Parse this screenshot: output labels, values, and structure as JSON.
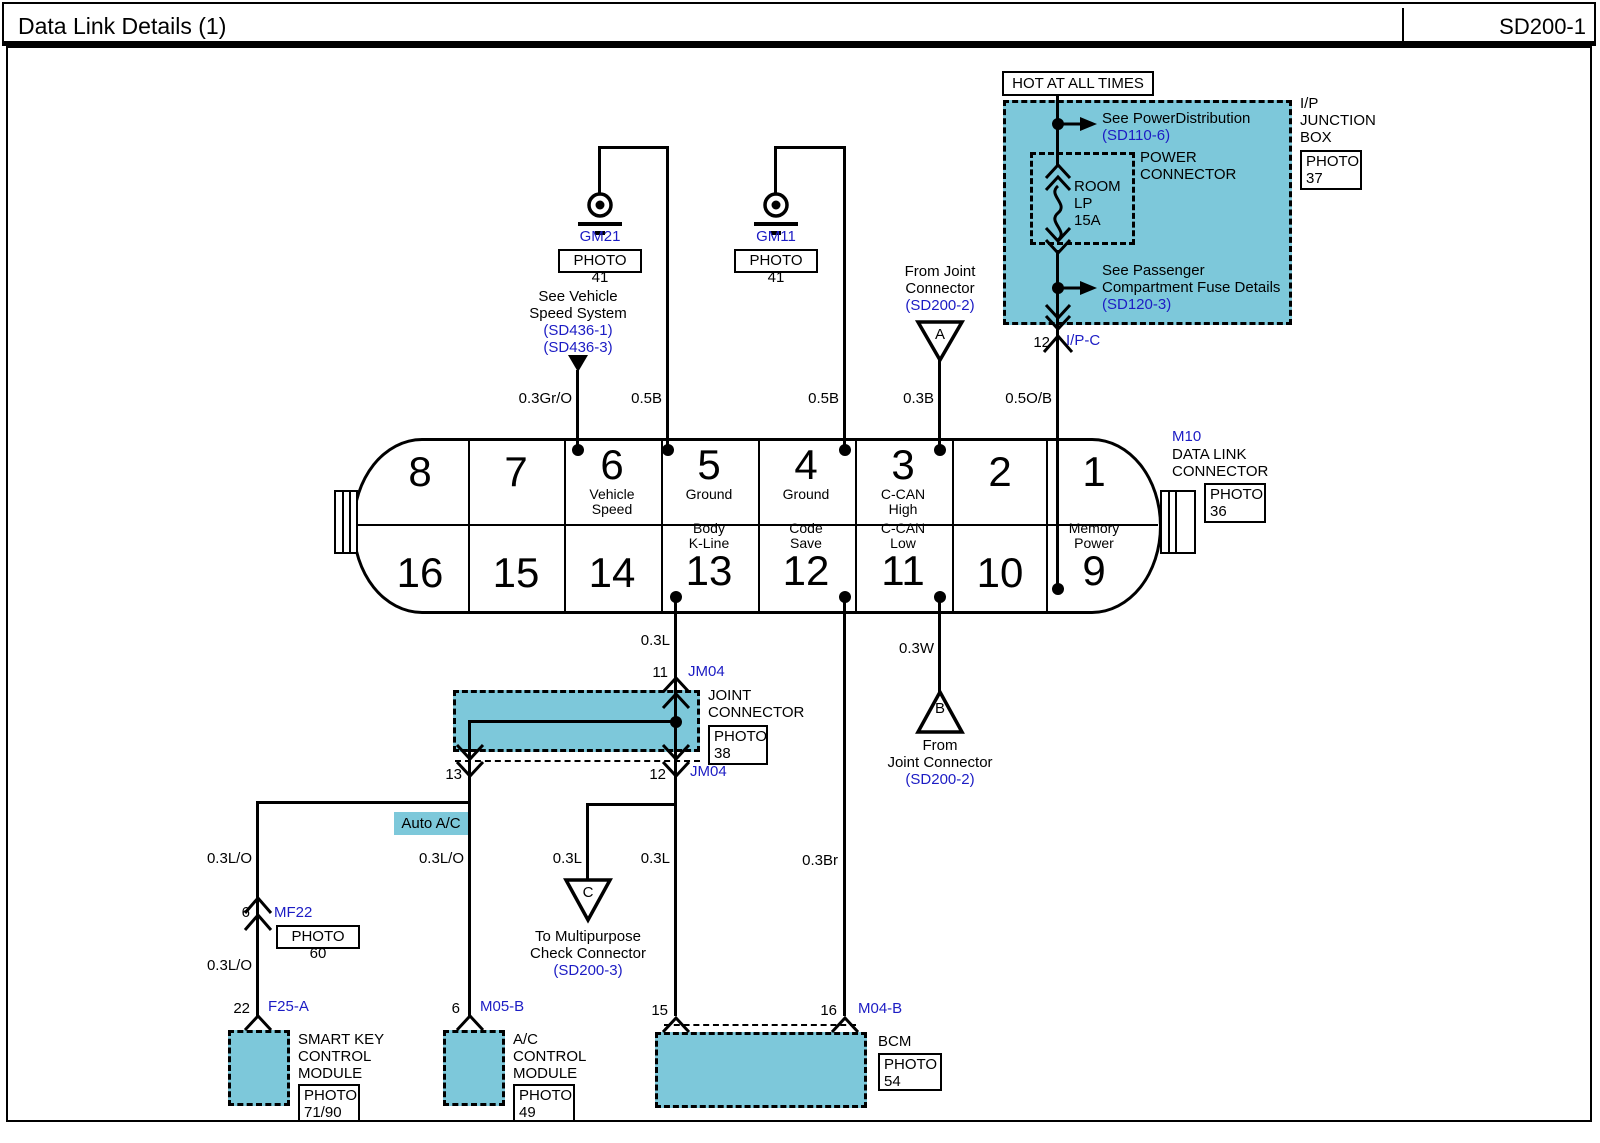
{
  "header": {
    "title": "Data Link Details (1)",
    "code": "SD200-1"
  },
  "colors": {
    "teal": "#7dc8da",
    "link_blue": "#1c1cc4",
    "wire_black": "#000000"
  },
  "power_circuit": {
    "hot": "HOT AT ALL TIMES",
    "dist_text": "See PowerDistribution",
    "dist_ref": "(SD110-6)",
    "pc_line1": "POWER",
    "pc_line2": "CONNECTOR",
    "fuse_line1": "ROOM",
    "fuse_line2": "LP",
    "fuse_line3": "15A",
    "pass_line1": "See Passenger",
    "pass_line2": "Compartment Fuse Details",
    "pass_ref": "(SD120-3)",
    "box_line1": "I/P",
    "box_line2": "JUNCTION",
    "box_line3": "BOX",
    "photo_label": "PHOTO",
    "photo_num": "37",
    "out_pin": "12",
    "out_conn": "I/P-C"
  },
  "grounds": {
    "g1_name": "GM21",
    "g1_photo": "PHOTO 41",
    "g2_name": "GM11",
    "g2_photo": "PHOTO 41"
  },
  "speed_ref": {
    "line1": "See Vehicle",
    "line2": "Speed System",
    "ref1": "(SD436-1)",
    "ref2": "(SD436-3)"
  },
  "tri_a": {
    "letter": "A",
    "line1": "From Joint",
    "line2": "Connector",
    "ref": "(SD200-2)"
  },
  "tri_b": {
    "letter": "B",
    "line1": "From",
    "line2": "Joint Connector",
    "ref": "(SD200-2)"
  },
  "tri_c": {
    "letter": "C",
    "line1": "To Multipurpose",
    "line2": "Check Connector",
    "ref": "(SD200-3)"
  },
  "dlc": {
    "name": "M10",
    "desc1": "DATA LINK",
    "desc2": "CONNECTOR",
    "photo_label": "PHOTO",
    "photo_num": "36",
    "top": [
      {
        "num": "8"
      },
      {
        "num": "7"
      },
      {
        "num": "6",
        "l1": "Vehicle",
        "l2": "Speed"
      },
      {
        "num": "5",
        "l1": "Ground"
      },
      {
        "num": "4",
        "l1": "Ground"
      },
      {
        "num": "3",
        "l1": "C-CAN",
        "l2": "High"
      },
      {
        "num": "2"
      },
      {
        "num": "1"
      }
    ],
    "bottom": [
      {
        "num": "16"
      },
      {
        "num": "15"
      },
      {
        "num": "14"
      },
      {
        "num": "13",
        "l1": "Body",
        "l2": "K-Line"
      },
      {
        "num": "12",
        "l1": "Code",
        "l2": "Save"
      },
      {
        "num": "11",
        "l1": "C-CAN",
        "l2": "Low"
      },
      {
        "num": "10"
      },
      {
        "num": "9",
        "l1": "Memory",
        "l2": "Power"
      }
    ]
  },
  "jm04": {
    "pin_top": "11",
    "name_top": "JM04",
    "pin_left": "13",
    "pin_right": "12",
    "name_bottom": "JM04",
    "label1": "JOINT",
    "label2": "CONNECTOR",
    "photo_label": "PHOTO",
    "photo_num": "38"
  },
  "mf22": {
    "pin": "6",
    "name": "MF22",
    "photo": "PHOTO 60"
  },
  "highlight": "Auto A/C",
  "wires": {
    "pin6": "0.3Gr/O",
    "pin5": "0.5B",
    "pin4": "0.5B",
    "pin3": "0.3B",
    "pin9": "0.5O/B",
    "pin13": "0.3L",
    "pin11": "0.3W",
    "left_upper": "0.3L/O",
    "left_lower": "0.3L/O",
    "mid": "0.3L/O",
    "c_branch": "0.3L",
    "bcm15": "0.3L",
    "bcm16": "0.3Br"
  },
  "smart_key": {
    "pin": "22",
    "conn": "F25-A",
    "line1": "SMART KEY",
    "line2": "CONTROL",
    "line3": "MODULE",
    "photo_label": "PHOTO",
    "photo_num": "71/90"
  },
  "ac_module": {
    "pin": "6",
    "conn": "M05-B",
    "line1": "A/C",
    "line2": "CONTROL",
    "line3": "MODULE",
    "photo_label": "PHOTO",
    "photo_num": "49"
  },
  "bcm": {
    "pin15": "15",
    "pin16": "16",
    "conn": "M04-B",
    "name": "BCM",
    "photo_label": "PHOTO",
    "photo_num": "54"
  }
}
